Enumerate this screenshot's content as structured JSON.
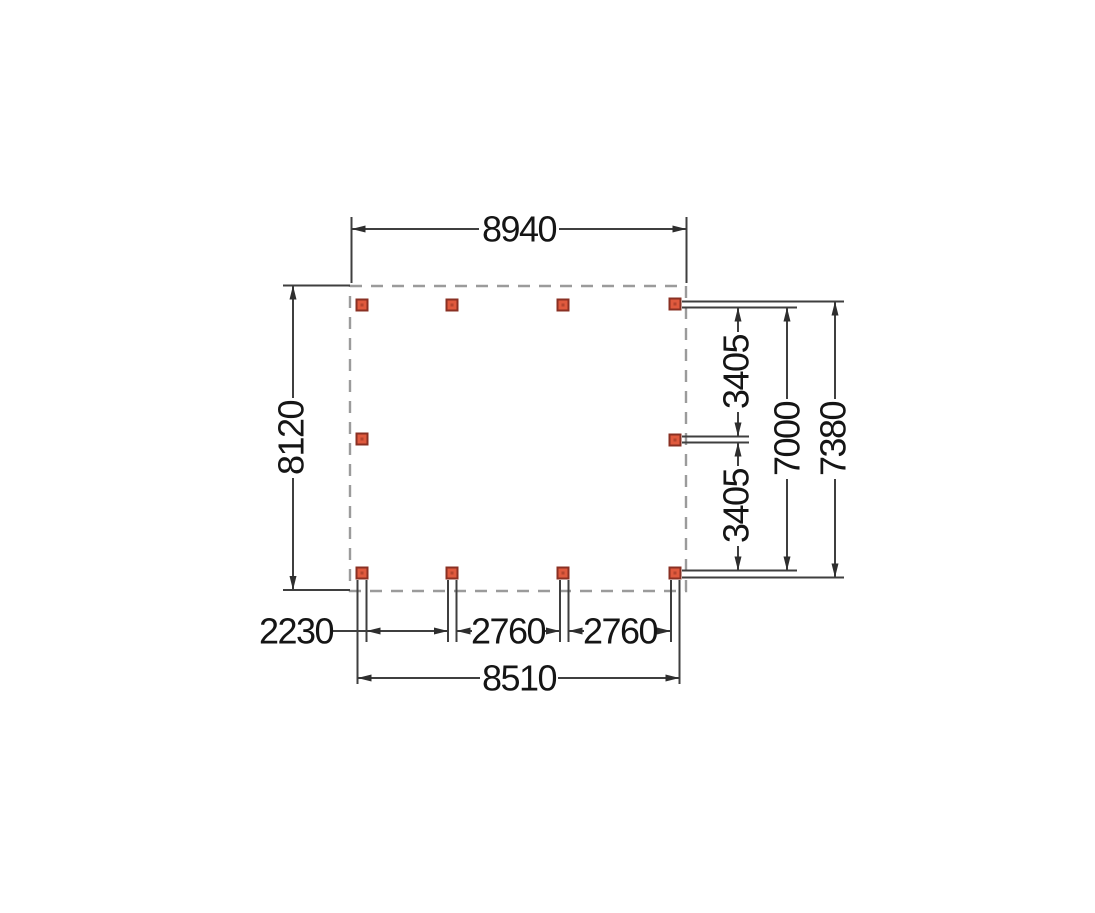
{
  "plan": {
    "description": "Top-view floor plan of rectangular canopy frame with 10 posts and dimension lines (mm)",
    "labels": {
      "width_top": "8940",
      "height_left": "8120",
      "right_upper_bay": "3405",
      "right_lower_bay": "3405",
      "right_inner_total": "7000",
      "right_outer_total": "7380",
      "bottom_bay_1": "2230",
      "bottom_bay_2": "2760",
      "bottom_bay_3": "2760",
      "bottom_total": "8510"
    },
    "posts": [
      {
        "x": 362,
        "y": 305
      },
      {
        "x": 452,
        "y": 305
      },
      {
        "x": 563,
        "y": 305
      },
      {
        "x": 675,
        "y": 304
      },
      {
        "x": 362,
        "y": 439
      },
      {
        "x": 675,
        "y": 440
      },
      {
        "x": 362,
        "y": 573
      },
      {
        "x": 452,
        "y": 573
      },
      {
        "x": 563,
        "y": 573
      },
      {
        "x": 675,
        "y": 573
      }
    ],
    "post": {
      "size": 11,
      "core_size": 3
    },
    "colors": {
      "line": "#3f3f3f",
      "arrow": "#2e2e2e",
      "text": "#151515",
      "dash": "#9b9b9b",
      "post_fill": "#e05a3e",
      "post_stroke": "#8a3023",
      "post_core": "#b5442e"
    }
  }
}
